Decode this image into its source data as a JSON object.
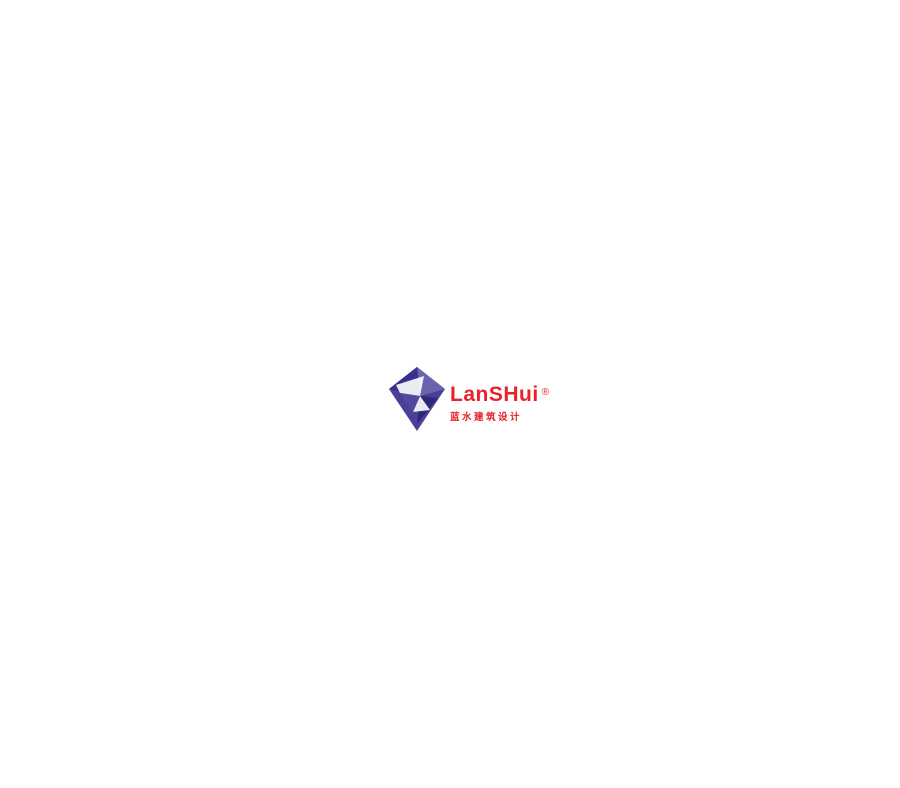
{
  "legend": {
    "items": [
      {
        "num": "1",
        "label": "Recycled steel construction, foundation and roof panels"
      },
      {
        "num": "2",
        "label": "Green roof"
      },
      {
        "num": "3",
        "label": "Willows filter ( water purification)"
      },
      {
        "num": "4",
        "label": "Ground wall as a heat buffer"
      },
      {
        "num": "5",
        "label": "Underfloor heating / cooling"
      },
      {
        "num": "6",
        "label": "Biomass heater"
      },
      {
        "num": "7",
        "label": "River cooling"
      },
      {
        "num": "8",
        "label": "Solar heat-resistant glass"
      },
      {
        "num": "9",
        "label": "Waterwheel to generate electricity"
      },
      {
        "num": "10",
        "label": "Local willow for biomass heater"
      },
      {
        "num": "11",
        "label": "Local water and food for restaurant"
      }
    ]
  },
  "watermark": {
    "brand": "LanSHui",
    "reg": "®",
    "subtitle": "蓝水建筑设计",
    "bottom_text": "广州蓝水"
  },
  "annotations": {
    "markers": [
      {
        "n": "1",
        "x": 648,
        "y": 75
      },
      {
        "n": "2",
        "x": 352,
        "y": 84
      },
      {
        "n": "3",
        "x": 797,
        "y": 539
      },
      {
        "n": "4",
        "x": 676,
        "y": 468
      },
      {
        "n": "5",
        "x": 435,
        "y": 459
      },
      {
        "n": "6",
        "x": 485,
        "y": 501
      },
      {
        "n": "7",
        "x": 780,
        "y": 613
      },
      {
        "n": "8",
        "x": 295,
        "y": 433
      },
      {
        "n": "9",
        "x": 721,
        "y": 627
      },
      {
        "n": "10",
        "x": 596,
        "y": 700
      },
      {
        "n": "11",
        "x": 398,
        "y": 403
      }
    ]
  },
  "colors": {
    "roof_dark": "#5d8324",
    "roof_mid": "#6fa62a",
    "roof_light": "#8cc63e",
    "frame": "#454545",
    "river": "#d9edf8",
    "pond": "#8fc3dd",
    "pond_dark": "#5d9fc4",
    "road": "#87898c",
    "plaza": "#7a7b7e",
    "land": "#ebecec",
    "hatch": "#e59aa4",
    "glass_yellow": "#ffd91c",
    "pipe_brown": "#7b4a2a",
    "accent_red": "#e8212a",
    "accent_blue": "#2aabe2",
    "marker_bg": "#111111",
    "legend_text": "#3b3b3b",
    "watermark_red": "#e8212a",
    "logo_purple": "#4b3f97",
    "reed_gray": "#b2b4b6",
    "reed_green": "#4c7d28"
  }
}
